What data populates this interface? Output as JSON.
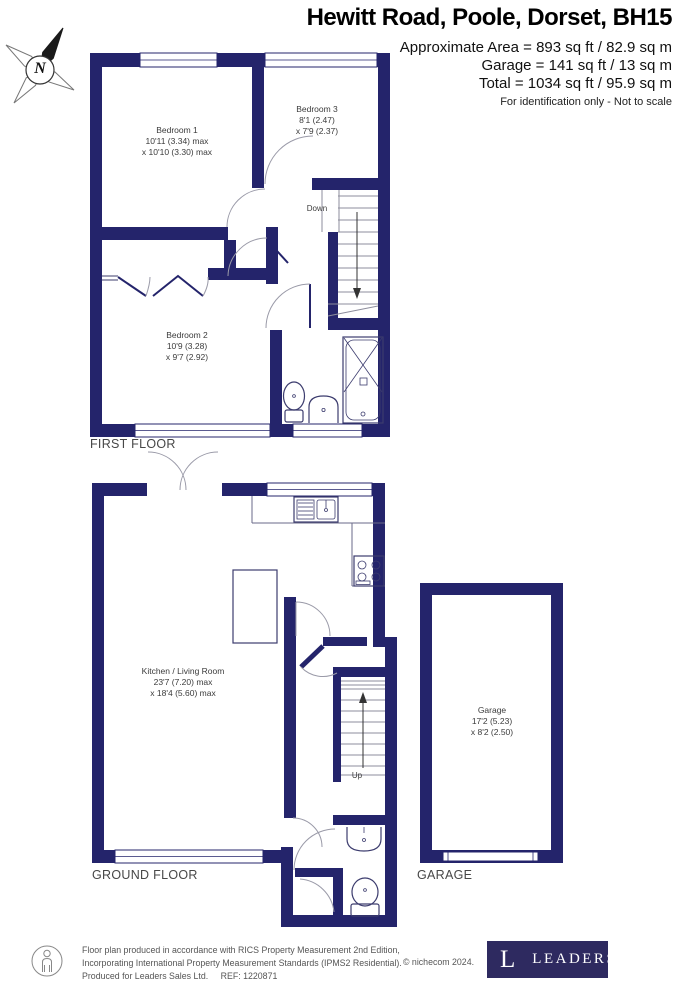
{
  "header": {
    "title": "Hewitt Road, Poole, Dorset, BH15",
    "line1": "Approximate Area = 893 sq ft / 82.9 sq m",
    "line2": "Garage = 141 sq ft / 13 sq m",
    "line3": "Total = 1034 sq ft / 95.9 sq m",
    "note": "For identification only - Not to scale"
  },
  "compass": {
    "label": "N"
  },
  "floors": {
    "first": {
      "title": "FIRST FLOOR",
      "stairs_label": "Down",
      "rooms": {
        "bedroom1": {
          "name": "Bedroom 1",
          "dim1": "10'11 (3.34) max",
          "dim2": "x 10'10 (3.30) max"
        },
        "bedroom3": {
          "name": "Bedroom 3",
          "dim1": "8'1 (2.47)",
          "dim2": "x 7'9 (2.37)"
        },
        "bedroom2": {
          "name": "Bedroom 2",
          "dim1": "10'9 (3.28)",
          "dim2": "x 9'7 (2.92)"
        }
      }
    },
    "ground": {
      "title": "GROUND FLOOR",
      "stairs_label": "Up",
      "rooms": {
        "kitchen_living": {
          "name": "Kitchen / Living Room",
          "dim1": "23'7 (7.20) max",
          "dim2": "x 18'4 (5.60) max"
        }
      }
    },
    "garage": {
      "title": "GARAGE",
      "room": {
        "name": "Garage",
        "dim1": "17'2 (5.23)",
        "dim2": "x 8'2 (2.50)"
      }
    }
  },
  "footer": {
    "line1": "Floor plan produced in accordance with RICS Property Measurement 2nd Edition,",
    "line2": "Incorporating International Property Measurement Standards (IPMS2 Residential).",
    "line3a": "Produced for Leaders Sales Ltd.",
    "line3b": "REF: 1220871",
    "copyright": "© nichecom 2024.",
    "logo_letter": "L",
    "logo_brand": "LEADERS"
  },
  "colors": {
    "wall": "#24246b",
    "logo_bg": "#2e2a60",
    "line": "#9a9aa8"
  }
}
